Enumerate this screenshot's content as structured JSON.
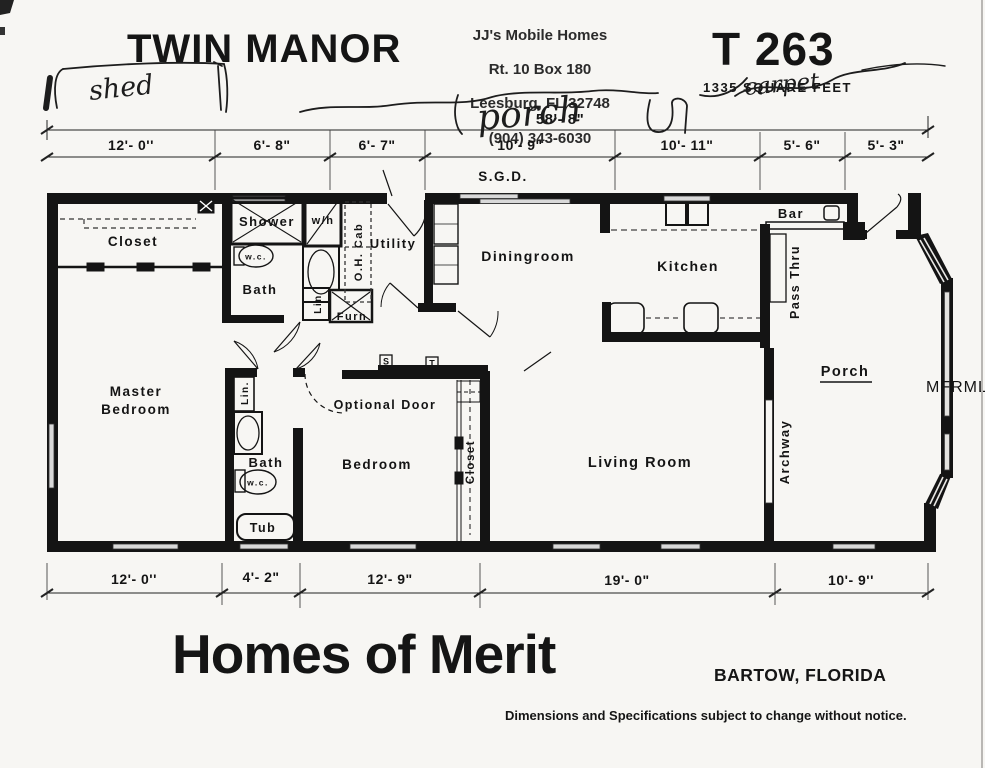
{
  "header": {
    "title": "TWIN MANOR",
    "dealer_stamp": {
      "line1": "JJ's Mobile Homes",
      "line2": "Rt. 10  Box 180",
      "line3": "Leesburg, FL  32748",
      "line4": "(904)  343-6030"
    },
    "model_number": "T 263",
    "square_feet": "1335 SQUARE FEET"
  },
  "annotations": {
    "shed": "shed",
    "porch": "porch",
    "carpet": "carpet"
  },
  "dimensions": {
    "overall_top": "58'- 8\"",
    "top": [
      "12'- 0''",
      "6'- 8\"",
      "6'- 7\"",
      "10'- 9\"",
      "10'- 11\"",
      "5'- 6\"",
      "5'- 3\""
    ],
    "bottom": [
      "12'- 0''",
      "4'- 2\"",
      "12'- 9\"",
      "19'- 0\"",
      "10'- 9''"
    ]
  },
  "rooms": {
    "sgd": "S.G.D.",
    "closet1": "Closet",
    "shower": "Shower",
    "water_heater": "w/h",
    "wc1": "w.c.",
    "bath1": "Bath",
    "lin1": "Lin",
    "furnace": "Furn",
    "oh_cab": "O.H. Cab",
    "utility": "Utility",
    "dining": "Diningroom",
    "kitchen": "Kitchen",
    "bar": "Bar",
    "pass_thru": "Pass Thru",
    "master_line1": "Master",
    "master_line2": "Bedroom",
    "lin2": "Lin.",
    "bath2": "Bath",
    "wc2": "w.c.",
    "tub": "Tub",
    "optional_door": "Optional Door",
    "bedroom": "Bedroom",
    "closet2": "Closet",
    "living_room": "Living Room",
    "archway": "Archway",
    "porch": "Porch",
    "switch_s": "S",
    "switch_t": "T"
  },
  "footer": {
    "brand": "Homes of Merit",
    "location": "BARTOW, FLORIDA",
    "disclaimer": "Dimensions and Specifications subject to change without notice."
  },
  "watermark": "MFRMLS",
  "colors": {
    "ink": "#141414",
    "paper": "#f7f6f3",
    "window": "#d9d9d9",
    "watermark": "#bfbfbf"
  }
}
